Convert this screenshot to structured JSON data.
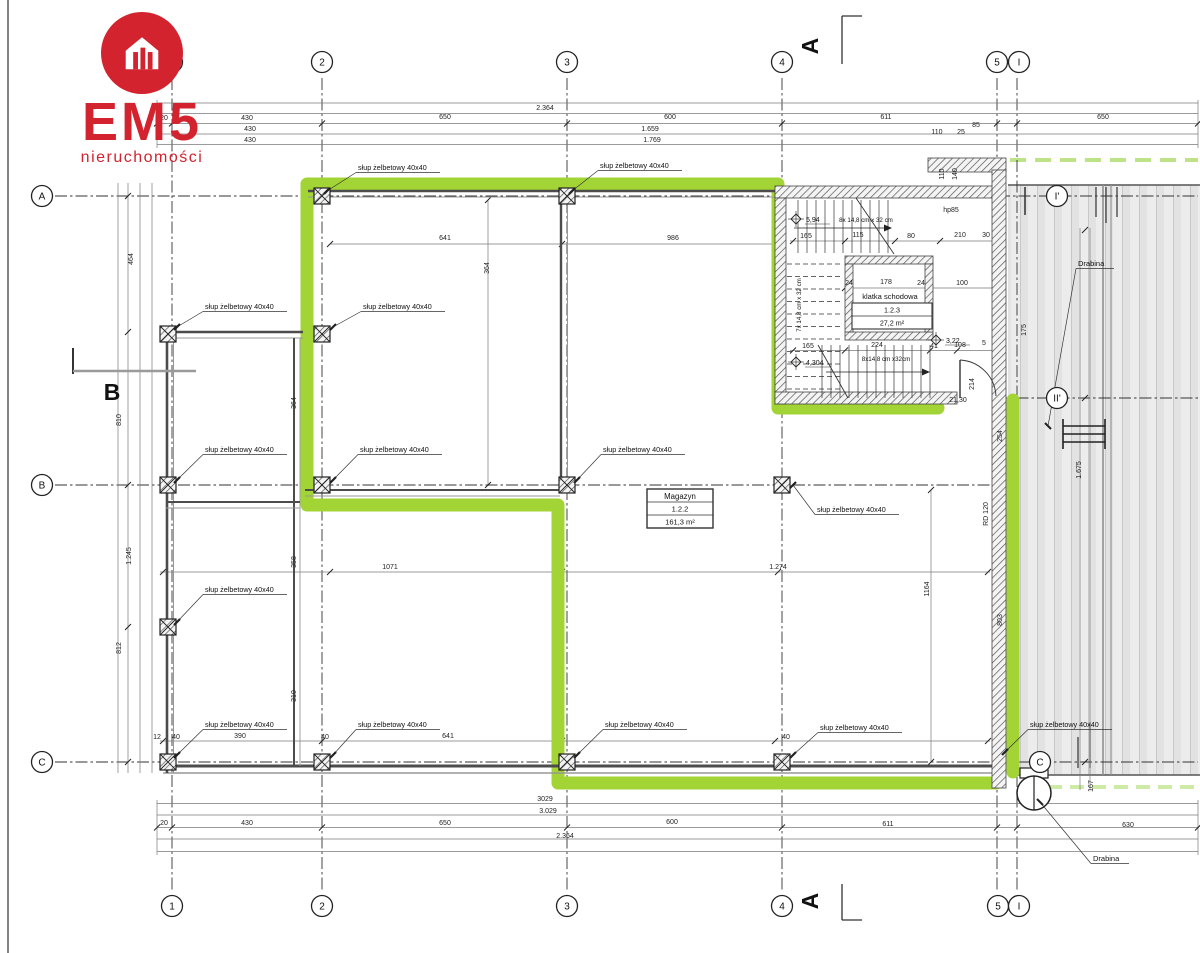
{
  "logo": {
    "brand": "EM5",
    "subtitle": "nieruchomości",
    "color": "#d2232e"
  },
  "colors": {
    "highlight": "#a3d435",
    "highlight_dash": "#bde287",
    "highlight_dash_light": "#cdeaa6",
    "wall_dark": "#4c4c4c",
    "wall_light": "#979797",
    "ramp_fill": "#ececec",
    "brand_red": "#d2232e"
  },
  "axes": {
    "bubbles": [
      {
        "label": "1",
        "x": 172,
        "y": 62
      },
      {
        "label": "2",
        "x": 322,
        "y": 62
      },
      {
        "label": "3",
        "x": 567,
        "y": 62
      },
      {
        "label": "4",
        "x": 782,
        "y": 62
      },
      {
        "label": "5",
        "x": 997,
        "y": 62
      },
      {
        "label": "I",
        "x": 1019,
        "y": 62
      },
      {
        "label": "1",
        "x": 172,
        "y": 906
      },
      {
        "label": "2",
        "x": 322,
        "y": 906
      },
      {
        "label": "3",
        "x": 567,
        "y": 906
      },
      {
        "label": "4",
        "x": 782,
        "y": 906
      },
      {
        "label": "5",
        "x": 998,
        "y": 906
      },
      {
        "label": "I",
        "x": 1019,
        "y": 906
      },
      {
        "label": "A",
        "x": 42,
        "y": 196
      },
      {
        "label": "B",
        "x": 42,
        "y": 485
      },
      {
        "label": "C",
        "x": 42,
        "y": 762
      },
      {
        "label": "I'",
        "x": 1057,
        "y": 196
      },
      {
        "label": "II'",
        "x": 1057,
        "y": 398
      },
      {
        "label": "C",
        "x": 1040,
        "y": 762
      }
    ]
  },
  "section_markers": [
    {
      "label": "A",
      "x": 818,
      "y": 46,
      "rot": -90
    },
    {
      "label": "A",
      "x": 818,
      "y": 901,
      "rot": -90
    },
    {
      "label": "B",
      "x": 112,
      "y": 400,
      "rot": 0
    }
  ],
  "rooms": {
    "magazyn": {
      "name": "Magazyn",
      "number": "1.2.2",
      "area": "161,3 m²"
    },
    "stairwell": {
      "name": "klatka schodowa",
      "number": "1.2.3",
      "area": "27,2 m²"
    }
  },
  "labels": {
    "column": "słup żelbetowy 40x40",
    "ladder": "Drabina"
  },
  "column_labels": [
    {
      "x": 358,
      "y": 170,
      "cx": 322,
      "cy": 196
    },
    {
      "x": 600,
      "y": 168,
      "cx": 567,
      "cy": 196
    },
    {
      "x": 205,
      "y": 309,
      "cx": 172,
      "cy": 332
    },
    {
      "x": 363,
      "y": 309,
      "cx": 328,
      "cy": 332
    },
    {
      "x": 205,
      "y": 452,
      "cx": 172,
      "cy": 485
    },
    {
      "x": 360,
      "y": 452,
      "cx": 328,
      "cy": 485
    },
    {
      "x": 603,
      "y": 452,
      "cx": 572,
      "cy": 485
    },
    {
      "x": 817,
      "y": 512,
      "cx": 788,
      "cy": 490
    },
    {
      "x": 205,
      "y": 592,
      "cx": 172,
      "cy": 627
    },
    {
      "x": 205,
      "y": 727,
      "cx": 172,
      "cy": 760
    },
    {
      "x": 358,
      "y": 727,
      "cx": 328,
      "cy": 760
    },
    {
      "x": 605,
      "y": 727,
      "cx": 572,
      "cy": 760
    },
    {
      "x": 820,
      "y": 730,
      "cx": 788,
      "cy": 760
    },
    {
      "x": 1030,
      "y": 727,
      "cx": 1000,
      "cy": 757
    }
  ],
  "ladder_labels": [
    {
      "x": 1078,
      "y": 266,
      "lx": 1048,
      "ly": 426
    },
    {
      "x": 1093,
      "y": 861,
      "lx": 1040,
      "ly": 802
    }
  ],
  "stair": {
    "top": "8x 14,8 cm x 32 cm",
    "left": "7x 14,8 cm x 32 cm",
    "bottom": "8x14,8 cm x32cm"
  },
  "levels": [
    {
      "t": "5,94",
      "x": 806,
      "y": 222,
      "dx": 796,
      "dy": 219
    },
    {
      "t": "4,304",
      "x": 806,
      "y": 365,
      "dx": 796,
      "dy": 362
    },
    {
      "t": "3,22",
      "x": 946,
      "y": 343,
      "dx": 936,
      "dy": 340
    }
  ],
  "dim_texts": [
    {
      "t": "2.364",
      "x": 545,
      "y": 110
    },
    {
      "t": "430",
      "x": 247,
      "y": 120
    },
    {
      "t": "650",
      "x": 445,
      "y": 119
    },
    {
      "t": "600",
      "x": 670,
      "y": 119
    },
    {
      "t": "611",
      "x": 886,
      "y": 119
    },
    {
      "t": "650",
      "x": 1103,
      "y": 119
    },
    {
      "t": "430",
      "x": 250,
      "y": 131
    },
    {
      "t": "1.659",
      "x": 650,
      "y": 131
    },
    {
      "t": "110",
      "x": 937,
      "y": 134
    },
    {
      "t": "25",
      "x": 961,
      "y": 134
    },
    {
      "t": "85",
      "x": 976,
      "y": 127
    },
    {
      "t": "430",
      "x": 250,
      "y": 142
    },
    {
      "t": "1.769",
      "x": 652,
      "y": 142
    },
    {
      "t": "20",
      "x": 164,
      "y": 120
    },
    {
      "t": "110",
      "x": 944,
      "y": 174,
      "r": -90
    },
    {
      "t": "140",
      "x": 957,
      "y": 174,
      "r": -90
    },
    {
      "t": "3029",
      "x": 545,
      "y": 801
    },
    {
      "t": "3.029",
      "x": 548,
      "y": 813
    },
    {
      "t": "430",
      "x": 247,
      "y": 825
    },
    {
      "t": "650",
      "x": 445,
      "y": 825
    },
    {
      "t": "600",
      "x": 672,
      "y": 824
    },
    {
      "t": "611",
      "x": 888,
      "y": 826
    },
    {
      "t": "630",
      "x": 1128,
      "y": 827
    },
    {
      "t": "2.364",
      "x": 565,
      "y": 838
    },
    {
      "t": "20",
      "x": 164,
      "y": 825
    },
    {
      "t": "464",
      "x": 133,
      "y": 259,
      "r": -90
    },
    {
      "t": "810",
      "x": 121,
      "y": 420,
      "r": -90
    },
    {
      "t": "1.245",
      "x": 131,
      "y": 556,
      "r": -90
    },
    {
      "t": "812",
      "x": 121,
      "y": 648,
      "r": -90
    },
    {
      "t": "364",
      "x": 296,
      "y": 403,
      "r": -90
    },
    {
      "t": "358",
      "x": 296,
      "y": 562,
      "r": -90
    },
    {
      "t": "310",
      "x": 296,
      "y": 696,
      "r": -90
    },
    {
      "t": "641",
      "x": 445,
      "y": 240
    },
    {
      "t": "986",
      "x": 673,
      "y": 240
    },
    {
      "t": "364",
      "x": 489,
      "y": 268,
      "r": -90
    },
    {
      "t": "1071",
      "x": 390,
      "y": 569
    },
    {
      "t": "1.274",
      "x": 778,
      "y": 569
    },
    {
      "t": "1164",
      "x": 929,
      "y": 589,
      "r": -90
    },
    {
      "t": "390",
      "x": 240,
      "y": 738
    },
    {
      "t": "641",
      "x": 448,
      "y": 738
    },
    {
      "t": "12",
      "x": 157,
      "y": 739
    },
    {
      "t": "40",
      "x": 176,
      "y": 739
    },
    {
      "t": "40",
      "x": 325,
      "y": 739
    },
    {
      "t": "40",
      "x": 786,
      "y": 739
    },
    {
      "t": "254",
      "x": 1002,
      "y": 436,
      "r": -90
    },
    {
      "t": "803",
      "x": 1002,
      "y": 620,
      "r": -90
    },
    {
      "t": "1.675",
      "x": 1081,
      "y": 470,
      "r": -90
    },
    {
      "t": "175",
      "x": 1026,
      "y": 330,
      "r": -90
    },
    {
      "t": "RD 120",
      "x": 988,
      "y": 514,
      "r": -90
    },
    {
      "t": "167",
      "x": 1093,
      "y": 786,
      "r": -90
    },
    {
      "t": "165",
      "x": 806,
      "y": 238
    },
    {
      "t": "115",
      "x": 858,
      "y": 237
    },
    {
      "t": "80",
      "x": 911,
      "y": 238
    },
    {
      "t": "210",
      "x": 960,
      "y": 237
    },
    {
      "t": "30",
      "x": 986,
      "y": 237
    },
    {
      "t": "24",
      "x": 849,
      "y": 285
    },
    {
      "t": "178",
      "x": 886,
      "y": 284
    },
    {
      "t": "24",
      "x": 921,
      "y": 285
    },
    {
      "t": "100",
      "x": 962,
      "y": 285
    },
    {
      "t": "165",
      "x": 808,
      "y": 348
    },
    {
      "t": "224",
      "x": 877,
      "y": 347
    },
    {
      "t": "41",
      "x": 934,
      "y": 348
    },
    {
      "t": "108",
      "x": 960,
      "y": 347
    },
    {
      "t": "5",
      "x": 984,
      "y": 345
    },
    {
      "t": "hp85",
      "x": 951,
      "y": 212
    },
    {
      "t": "21,30",
      "x": 958,
      "y": 402
    },
    {
      "t": "214",
      "x": 974,
      "y": 384,
      "r": -90
    }
  ]
}
